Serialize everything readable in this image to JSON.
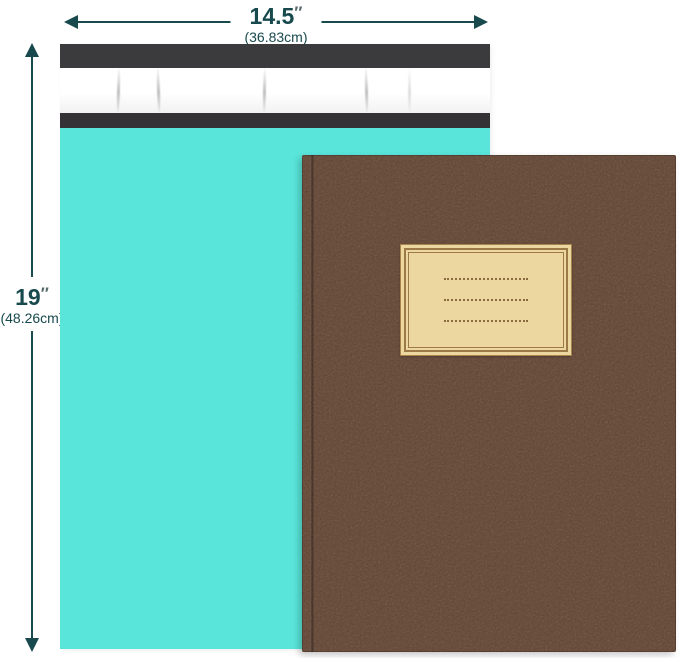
{
  "annotations": {
    "width": {
      "value": "14.5",
      "prime": "″",
      "metric": "(36.83cm)"
    },
    "height": {
      "value": "19",
      "prime": "″",
      "metric": "(48.26cm)"
    }
  },
  "objects": {
    "mailer": "teal-poly-mailer-envelope",
    "mailer_flap": "dark-fold-over-flap-with-adhesive-release-strip",
    "notebook": "brown-kraft-cover-notebook",
    "label": "blank-tan-title-label-with-three-dotted-write-in-lines",
    "label_rows": 3
  },
  "colors": {
    "annotation": "#17494d",
    "mailer-teal": "#59e5da",
    "flap-dark": "#3b3b3d",
    "flap-edge": "#343234",
    "strip-white": "#fdfdfd",
    "notebook-brown": "#5f4637",
    "label-tan": "#ecd7a0",
    "label-line": "#8a6b3f",
    "background": "#ffffff"
  }
}
